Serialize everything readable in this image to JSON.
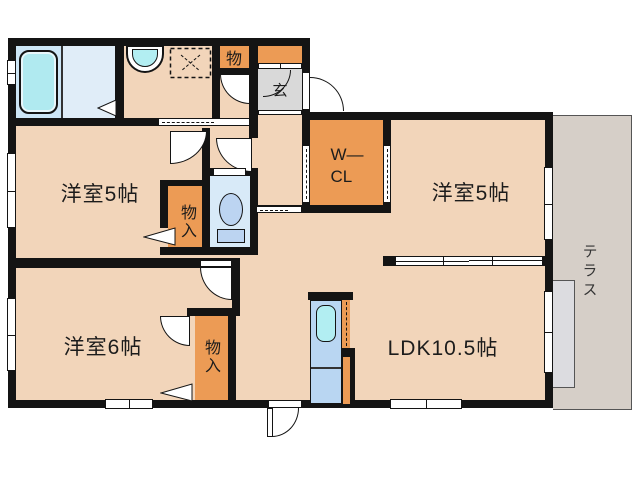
{
  "rooms": {
    "bedroom_top_left": {
      "label": "洋室5帖"
    },
    "bedroom_top_right": {
      "label": "洋室5帖"
    },
    "bedroom_bottom_left": {
      "label": "洋室6帖"
    },
    "ldk": {
      "label": "LDK10.5帖"
    },
    "walk_in_closet": {
      "line1": "W—",
      "line2": "CL"
    },
    "storage_hall": {
      "label": "物"
    },
    "storage_bedroom_tl": {
      "label": "物入"
    },
    "storage_bedroom_bl": {
      "label": "物入"
    },
    "entrance": {
      "label": "玄"
    },
    "terrace": {
      "label": "テラス"
    }
  },
  "colors": {
    "floor_peach": "#f2d5ba",
    "closet_orange": "#ec9b55",
    "bath_blue": "#cde6f6",
    "washer_blue": "#e0edf8",
    "toilet_blue": "#d8eaf8",
    "kitchen_blue": "#b9d6f2",
    "sink_cyan": "#b2eef2",
    "tub_cyan": "#b0eaf0",
    "entrance_gray": "#d9d9d9",
    "terrace_gray": "#d6cfc8",
    "terrace_step_gray": "#dcdce0",
    "wall_black": "#141414"
  }
}
